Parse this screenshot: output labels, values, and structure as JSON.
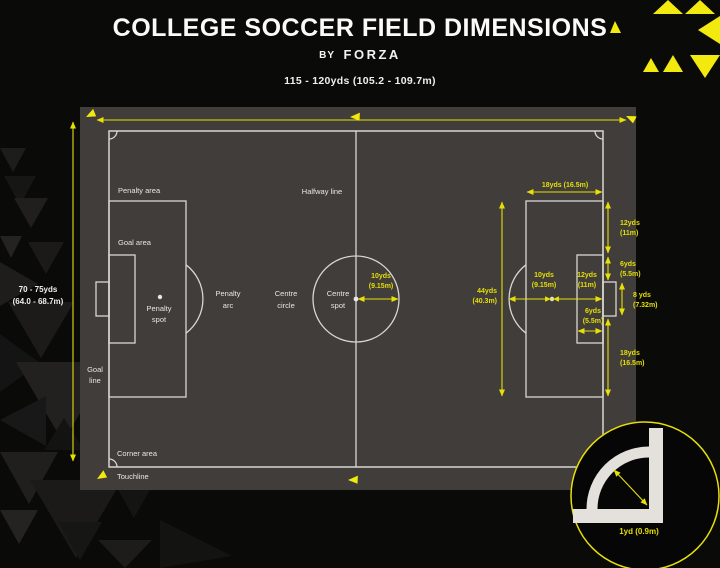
{
  "header": {
    "title": "COLLEGE SOCCER FIELD DIMENSIONS",
    "byline_prefix": "BY",
    "byline_brand": "FORZA",
    "field_length": "115 - 120yds (105.2 - 109.7m)"
  },
  "side_dimension": {
    "line1": "70 - 75yds",
    "line2": "(64.0 - 68.7m)"
  },
  "labels": {
    "penalty_area": "Penalty area",
    "goal_area": "Goal area",
    "penalty_spot": [
      "Penalty",
      "spot"
    ],
    "penalty_arc": [
      "Penalty",
      "arc"
    ],
    "centre_circle": [
      "Centre",
      "circle"
    ],
    "centre_spot": [
      "Centre",
      "spot"
    ],
    "halfway_line": "Halfway line",
    "goal_line": [
      "Goal",
      "line"
    ],
    "corner_area": "Corner area",
    "touchline": "Touchline"
  },
  "measurements": {
    "penalty_depth": "18yds (16.5m)",
    "centre_radius": [
      "10yds",
      "(9.15m)"
    ],
    "arc_to_spot": [
      "10yds",
      "(9.15m)"
    ],
    "spot_to_goal_line": [
      "12yds",
      "(11m)"
    ],
    "goal_area_depth": [
      "6yds",
      "(5.5m)"
    ],
    "penalty_area_width": [
      "44yds",
      "(40.3m)"
    ],
    "penalty_edge_to_goal_area": [
      "12yds",
      "(11m)"
    ],
    "goal_area_to_post": [
      "6yds",
      "(5.5m)"
    ],
    "goal_width": [
      "8 yds",
      "(7.32m)"
    ],
    "post_to_penalty_edge": [
      "18yds",
      "(16.5m)"
    ],
    "corner_arc_radius": "1yd (0.9m)"
  },
  "colors": {
    "accent_yellow": "#e6df08",
    "flag_yellow": "#f2e90f",
    "field_gray": "#5b5754",
    "mat_gray": "#403d3a",
    "line_white": "#d9d6d1",
    "background": "#0a0a09"
  }
}
